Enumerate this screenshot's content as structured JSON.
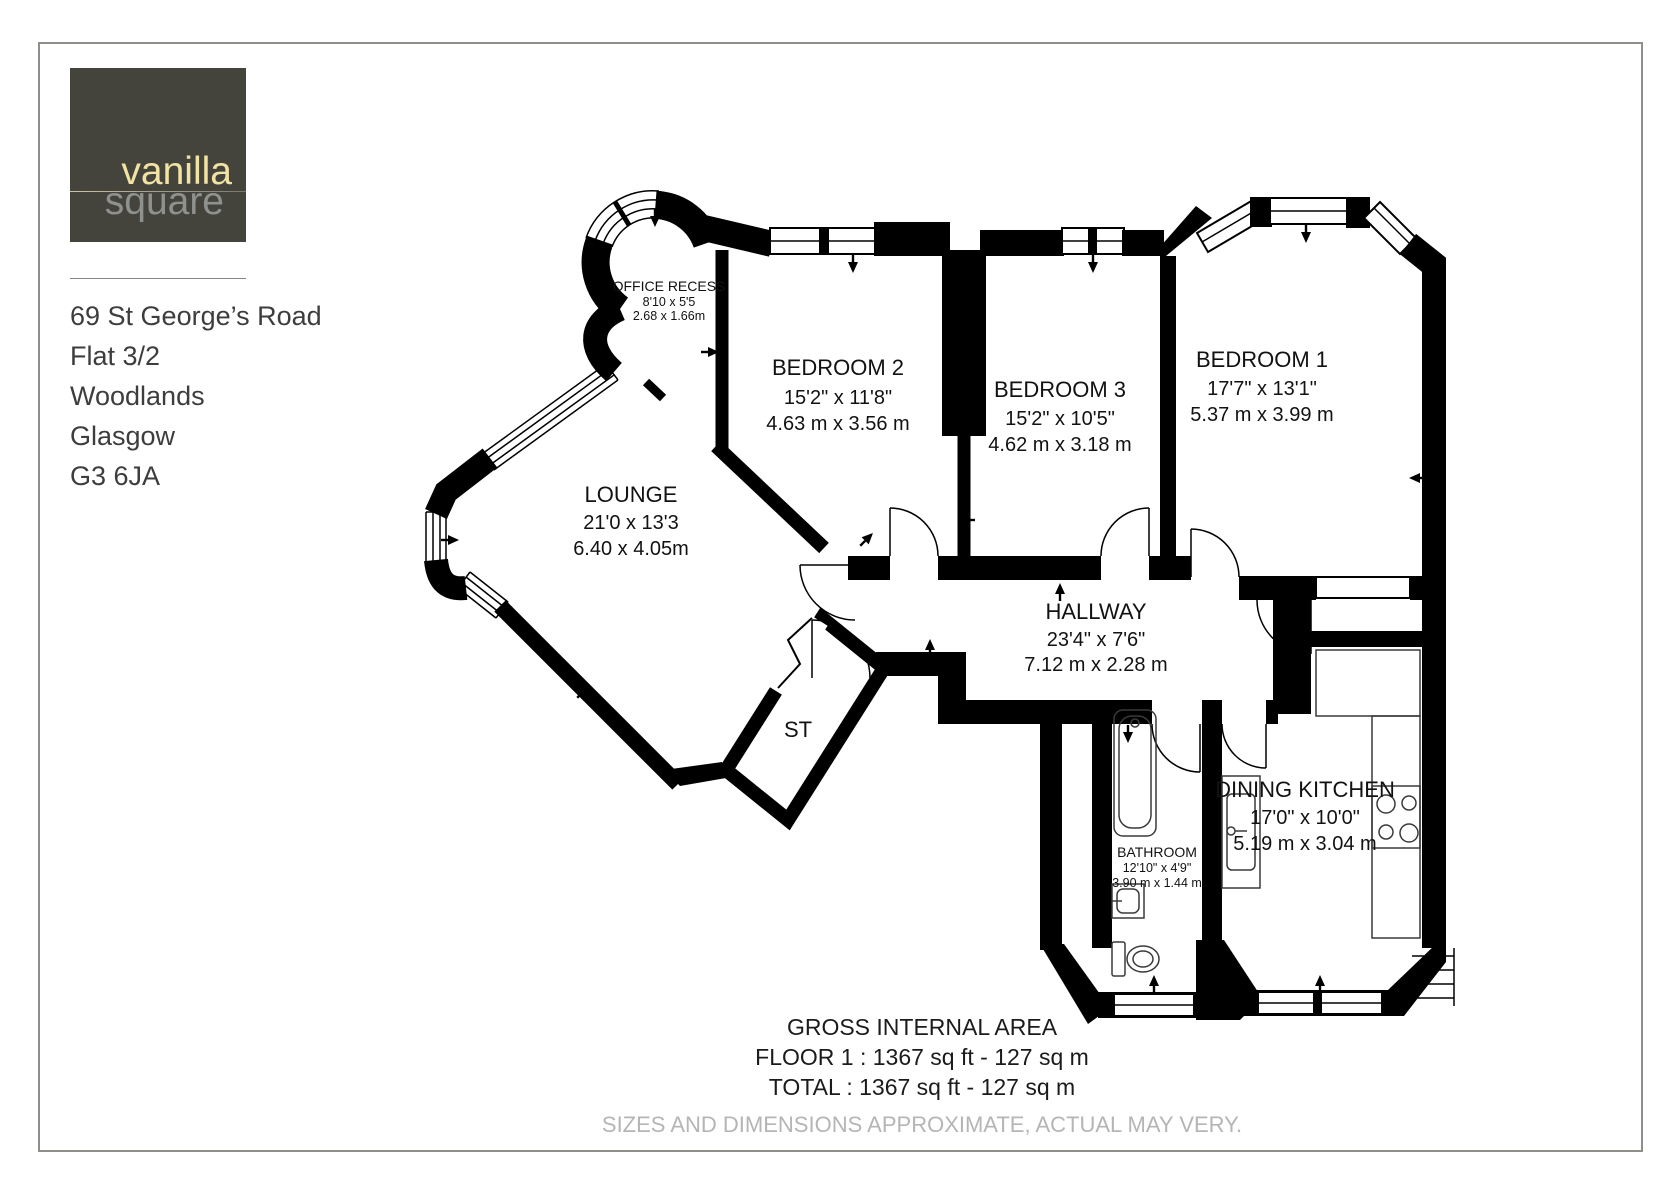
{
  "logo": {
    "brand_top": "vanilla",
    "brand_bottom": "square"
  },
  "address": {
    "lines": [
      "69 St George’s Road",
      "Flat 3/2",
      "Woodlands",
      "Glasgow",
      "G3 6JA"
    ]
  },
  "colors": {
    "wall": "#000000",
    "logo_bg": "#45443c",
    "brand_top": "#f1e3a3",
    "brand_bottom": "#8f918f",
    "page_border": "#8d9088",
    "disclaimer_grey": "#b5b5b5"
  },
  "plan": {
    "rooms": [
      {
        "id": "office-recess",
        "name": "OFFICE RECESS",
        "imperial": "8'10 x 5'5",
        "metric": "2.68 x 1.66m"
      },
      {
        "id": "bedroom-2",
        "name": "BEDROOM 2",
        "imperial": "15'2\" x 11'8\"",
        "metric": "4.63 m x 3.56 m"
      },
      {
        "id": "bedroom-3",
        "name": "BEDROOM 3",
        "imperial": "15'2\" x 10'5\"",
        "metric": "4.62 m x 3.18 m"
      },
      {
        "id": "bedroom-1",
        "name": "BEDROOM 1",
        "imperial": "17'7\" x 13'1\"",
        "metric": "5.37 m x 3.99 m"
      },
      {
        "id": "lounge",
        "name": "LOUNGE",
        "imperial": "21'0 x 13'3",
        "metric": "6.40 x 4.05m"
      },
      {
        "id": "hallway",
        "name": "HALLWAY",
        "imperial": "23'4\" x 7'6\"",
        "metric": "7.12 m x 2.28 m"
      },
      {
        "id": "storage",
        "name": "ST"
      },
      {
        "id": "bathroom",
        "name": "BATHROOM",
        "imperial": "12'10\" x 4'9\"",
        "metric": "3.90 m x 1.44 m"
      },
      {
        "id": "dining-kitchen",
        "name": "DINING KITCHEN",
        "imperial": "17'0\" x 10'0\"",
        "metric": "5.19 m x 3.04 m"
      }
    ],
    "footer": {
      "title": "GROSS INTERNAL AREA",
      "floor_line": "FLOOR 1 : 1367 sq ft - 127 sq m",
      "total_line": "TOTAL : 1367 sq ft - 127 sq m",
      "disclaimer": "SIZES AND DIMENSIONS APPROXIMATE, ACTUAL MAY VERY."
    }
  }
}
